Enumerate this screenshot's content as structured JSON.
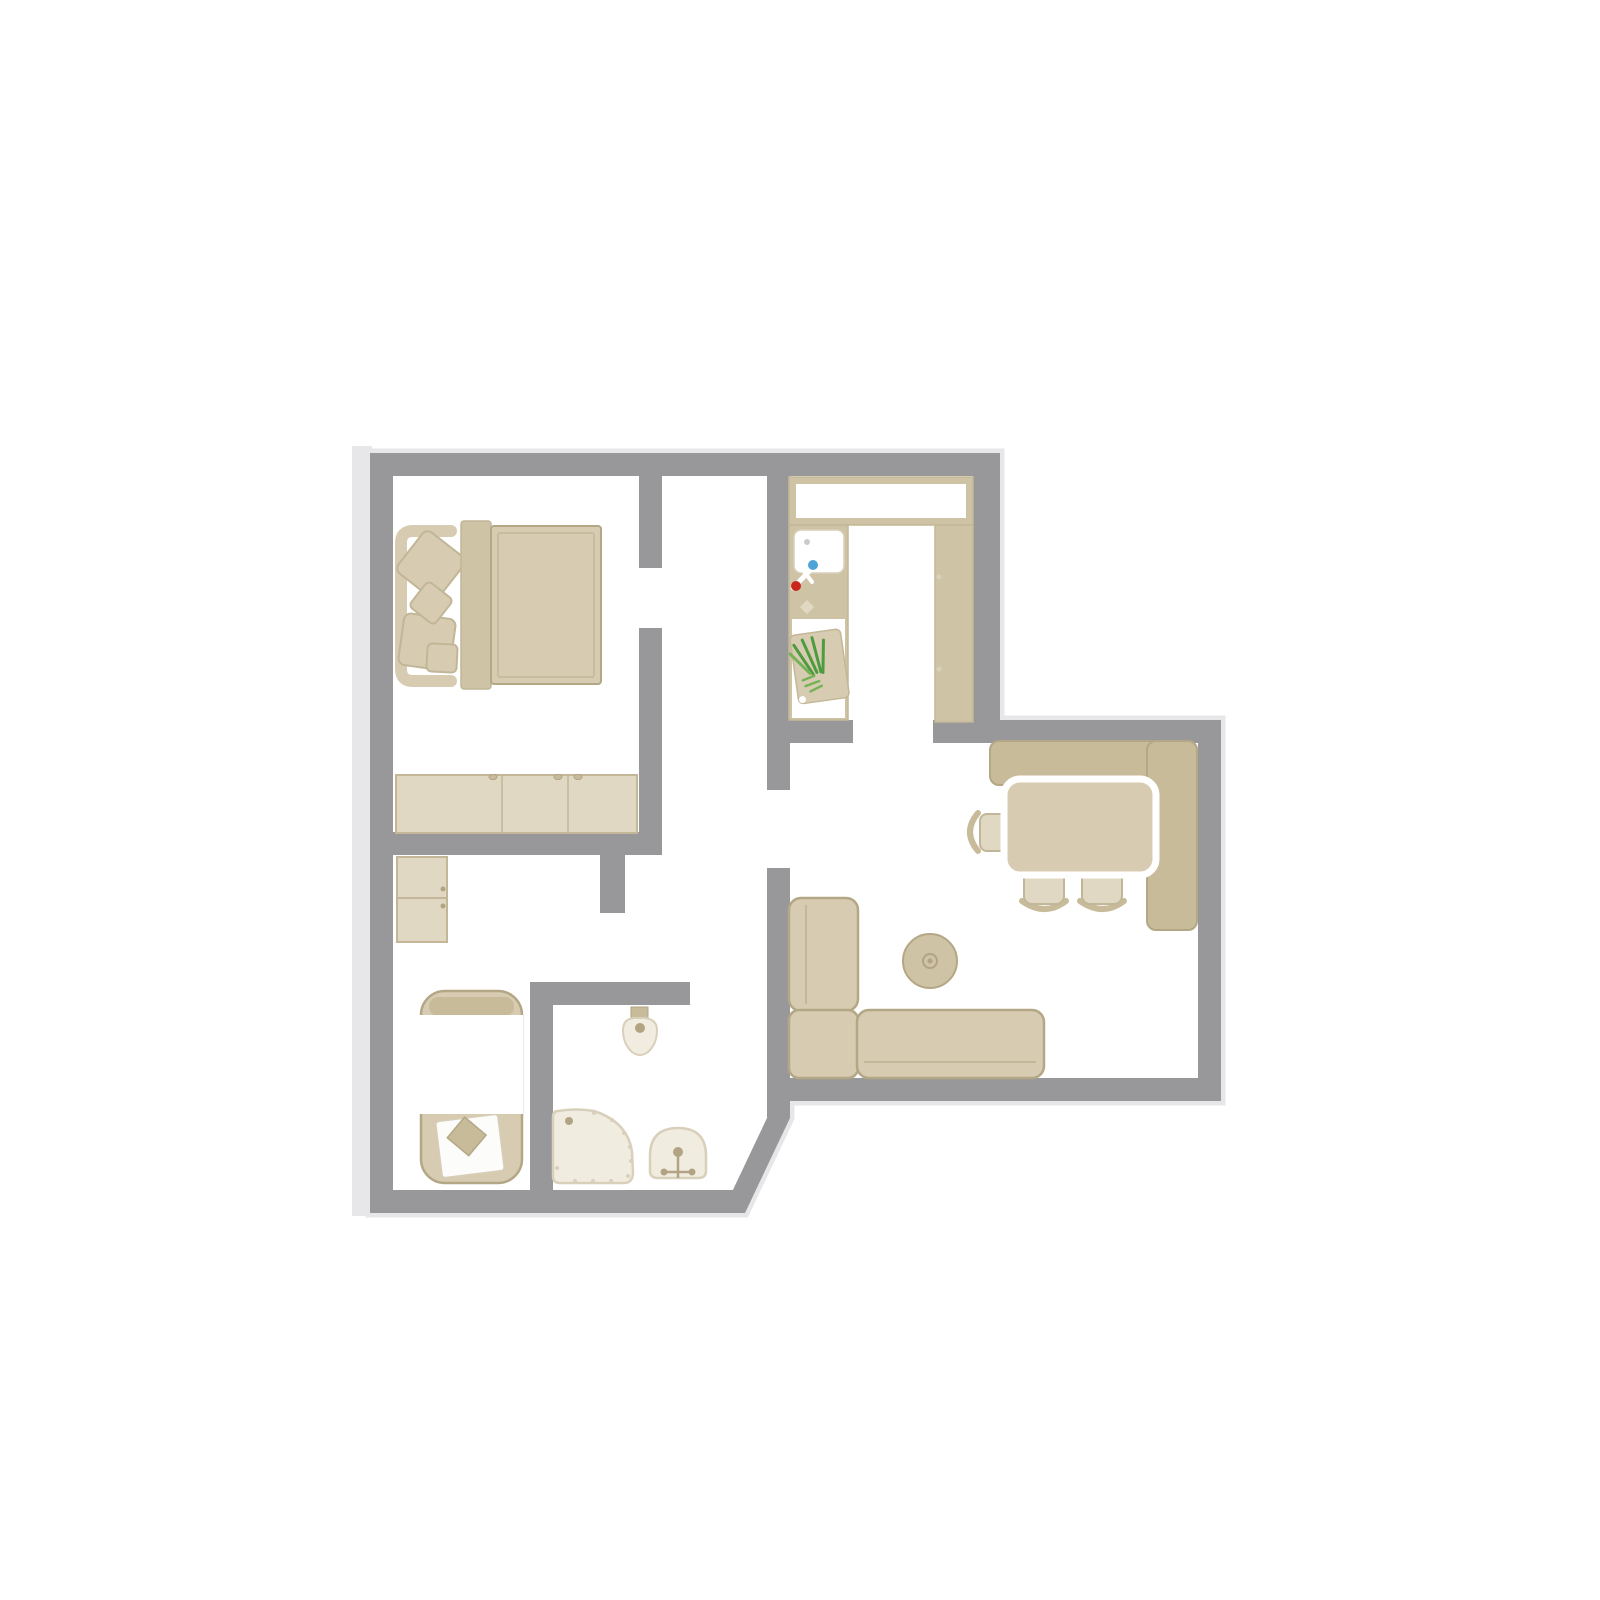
{
  "palette": {
    "wall": "#98989a",
    "shadow": "#e7e7e9",
    "floor": "#ffffff",
    "white": "#ffffff",
    "beige": "#d7ccb1",
    "beige_light": "#e0d8c2",
    "beige_mid": "#cfc3a5",
    "beige_dark": "#c8bb9a",
    "line": "#c3b797",
    "outline": "#b3a786",
    "outline_soft": "#c2b698",
    "cream": "#f1ece0",
    "cream_line": "#d8d0bb",
    "accent": "#b3a385",
    "knob": "#b0a485",
    "blue": "#4da3d8",
    "red": "#c9271c",
    "green": "#4e9b40",
    "green_light": "#76b356",
    "gray_dot": "#cbcbcb"
  },
  "plan": {
    "type": "apartment-floor-plan",
    "rooms": [
      {
        "name": "bedroom",
        "furniture": [
          "double-bed",
          "headboard",
          "pillows",
          "duvet",
          "sideboard"
        ]
      },
      {
        "name": "hallway",
        "furniture": [
          "wardrobe-cabinets"
        ]
      },
      {
        "name": "kitchen",
        "furniture": [
          "countertop-run",
          "sink-with-hot-cold-faucet",
          "cutting-board-with-leek",
          "tall-counter"
        ]
      },
      {
        "name": "dining-area",
        "furniture": [
          "corner-bench",
          "dining-table",
          "armchair",
          "side-chairs"
        ]
      },
      {
        "name": "living-area",
        "furniture": [
          "corner-sofa",
          "round-pouf"
        ]
      },
      {
        "name": "bathroom",
        "furniture": [
          "bathtub",
          "toilet",
          "corner-shower",
          "washbasin"
        ]
      }
    ]
  }
}
